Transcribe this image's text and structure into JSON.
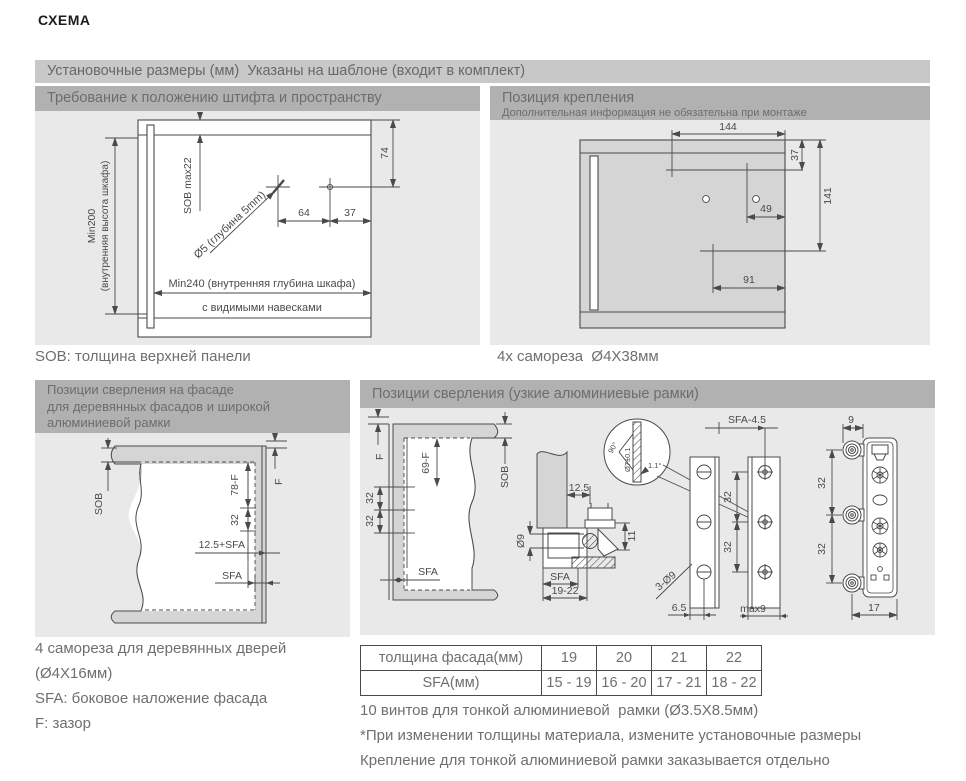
{
  "page_title": "СХЕМА",
  "top_bar": {
    "label": "Установочные размеры (мм)  Указаны на шаблоне (входит в комплект)"
  },
  "colors": {
    "top_bar_bg": "#c8c8c8",
    "panel_header_bg": "#b1b1b1",
    "panel_body_bg": "#e9e9e9",
    "diagram_fill": "#d5d5d5",
    "line": "#4a4a4a",
    "text_gray": "#6f6f6f"
  },
  "pin_panel": {
    "title": "Требование к положению штифта и пространству",
    "caption": "SOB: толщина верхней панели",
    "dims": {
      "min200": "Min200",
      "min200_sub": "(внутренняя высота шкафа)",
      "sob_max": "SOB max22",
      "drill": "Ø5 (глубина 5mm)",
      "d64": "64",
      "d37": "37",
      "d74": "74",
      "min240": "Min240 (внутренняя глубина шкафа)",
      "hinges": "с видимыми навесками"
    }
  },
  "mount_panel": {
    "title": "Позиция крепления",
    "subtitle": "Дополнительная информация не обязательна при монтаже",
    "caption": "4х самореза  Ø4X38мм",
    "dims": {
      "d144": "144",
      "d37": "37",
      "d141": "141",
      "d49": "49",
      "d91": "91"
    }
  },
  "wood_panel": {
    "title_line1": "Позиции сверления на фасаде",
    "title_line2": "для деревянных фасадов и широкой",
    "title_line3": "алюминиевой рамки",
    "dims": {
      "sob": "SOB",
      "f": "F",
      "d78f": "78-F",
      "d32": "32",
      "d125sfa": "12.5+SFA",
      "sfa": "SFA"
    },
    "caption_line1": "4 самореза для деревянных дверей",
    "caption_line2": "(Ø4X16мм)",
    "caption_line3": "SFA: боковое наложение фасада",
    "caption_line4": "F: зазор"
  },
  "alu_panel": {
    "title": "Позиции сверления (узкие алюминиевые рамки)",
    "dims": {
      "f": "F",
      "d69f": "69-F",
      "sob": "SOB",
      "d32": "32",
      "sfa": "SFA",
      "d125": "12.5",
      "d9_hole": "Ø9",
      "d11": "11",
      "d19_22": "19-22",
      "d90": "90°",
      "d7tol": "Ø7±0.1",
      "d1_1": "1.1°",
      "sfa45": "SFA-4.5",
      "d3_9": "3-Ø9",
      "d6_5": "6.5",
      "max9": "max9",
      "d9": "9",
      "d17": "17"
    },
    "table": {
      "row1_label": "толщина фасада(мм)",
      "row1_values": [
        "19",
        "20",
        "21",
        "22"
      ],
      "row2_label": "SFA(мм)",
      "row2_values": [
        "15 - 19",
        "16 - 20",
        "17 - 21",
        "18 - 22"
      ]
    },
    "note1": "10 винтов для тонкой алюминиевой  рамки (Ø3.5X8.5мм)",
    "note2": "*При изменении толщины материала, измените установочные размеры",
    "note3": "Крепление для тонкой алюминиевой рамки заказывается отдельно"
  }
}
